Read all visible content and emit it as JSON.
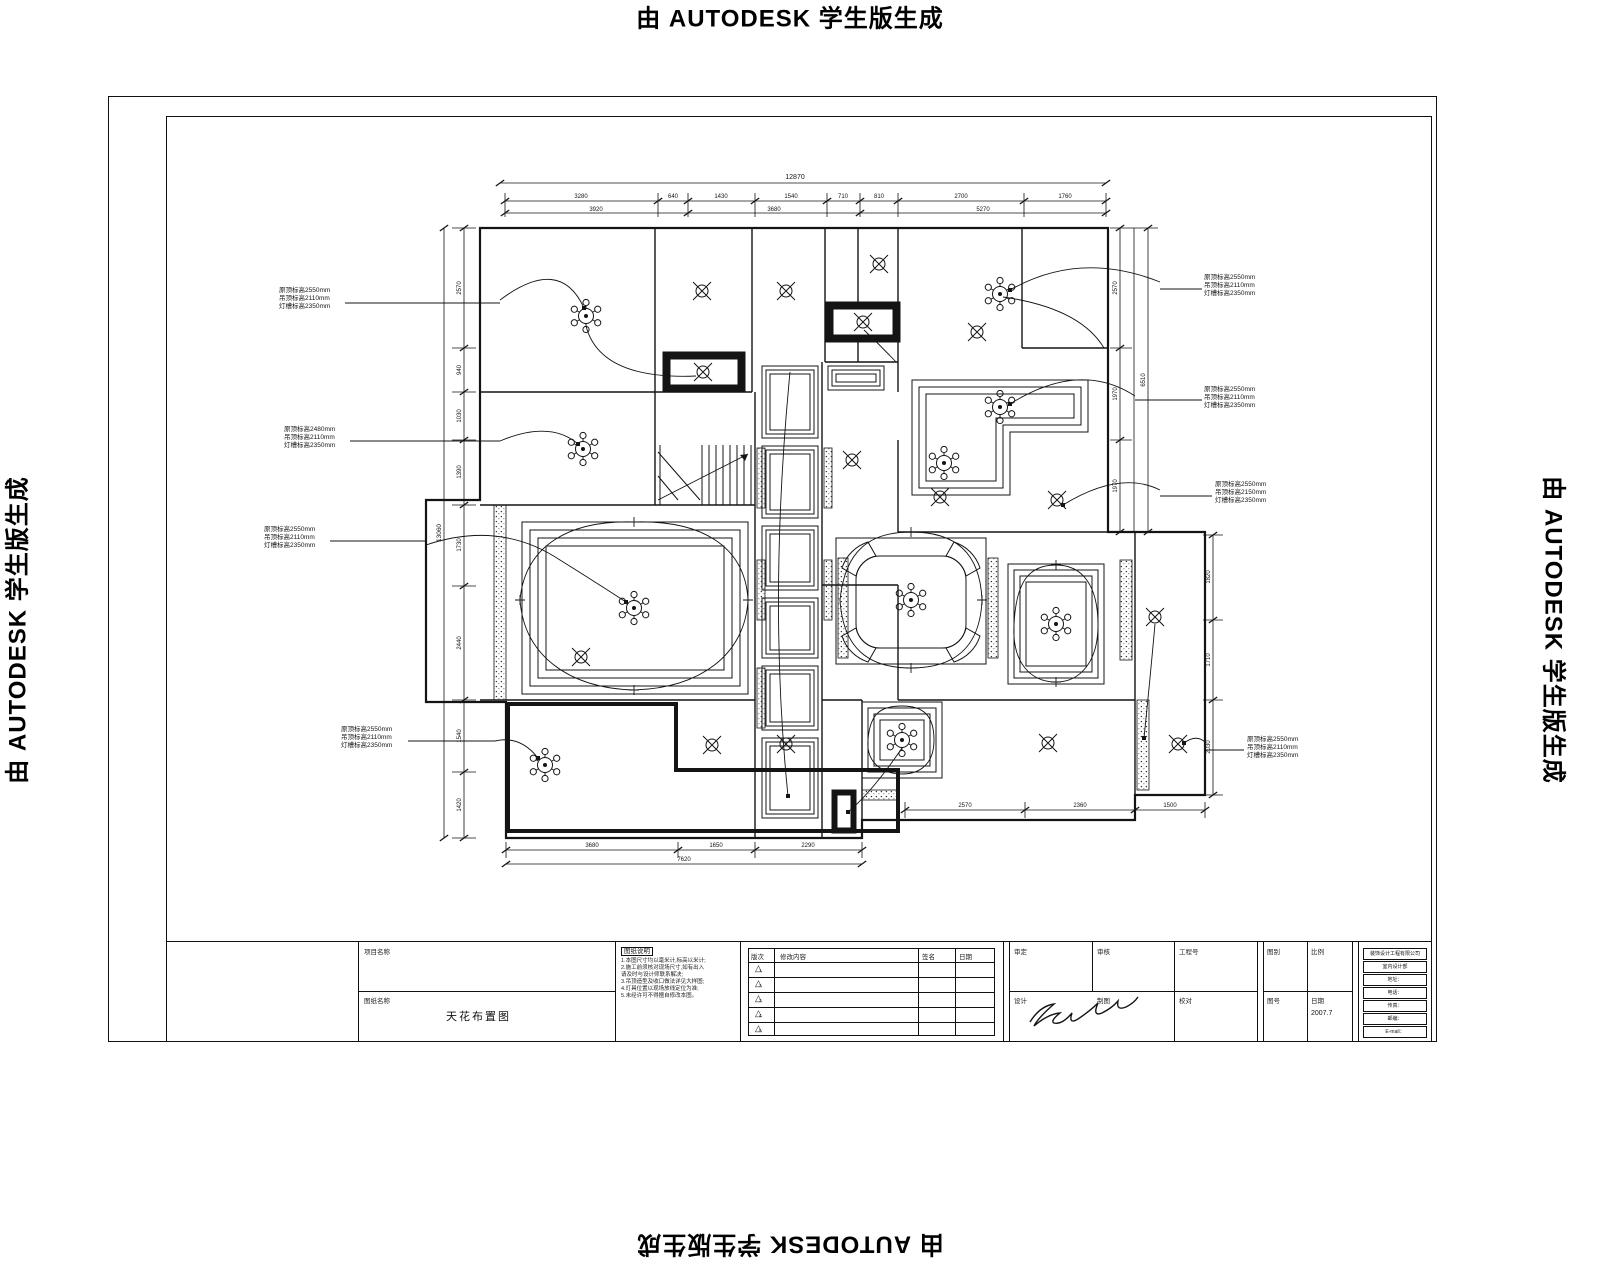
{
  "watermark": {
    "text": "由 AUTODESK 学生版生成"
  },
  "drawing": {
    "annotations": {
      "left": [
        {
          "lines": [
            "原顶标高2550mm",
            "吊顶标高2110mm",
            "灯槽标高2350mm"
          ]
        },
        {
          "lines": [
            "原顶标高2480mm",
            "吊顶标高2110mm",
            "灯槽标高2350mm"
          ]
        },
        {
          "lines": [
            "原顶标高2550mm",
            "吊顶标高2110mm",
            "灯槽标高2350mm"
          ]
        },
        {
          "lines": [
            "原顶标高2550mm",
            "吊顶标高2110mm",
            "灯槽标高2350mm"
          ]
        }
      ],
      "right": [
        {
          "lines": [
            "原顶标高2550mm",
            "吊顶标高2110mm",
            "灯槽标高2350mm"
          ]
        },
        {
          "lines": [
            "原顶标高2550mm",
            "吊顶标高2110mm",
            "灯槽标高2350mm"
          ]
        },
        {
          "lines": [
            "原顶标高2550mm",
            "吊顶标高2150mm",
            "灯槽标高2350mm"
          ]
        },
        {
          "lines": [
            "原顶标高2550mm",
            "吊顶标高2110mm",
            "灯槽标高2350mm"
          ]
        }
      ]
    },
    "dims": {
      "top_overall": "12870",
      "top": [
        "3280",
        "640",
        "1430",
        "1540",
        "710",
        "810",
        "2700",
        "1760"
      ],
      "top2": [
        "3920",
        "3680",
        "5270"
      ],
      "left": [
        "2570",
        "940",
        "1030",
        "1390",
        "1730",
        "2440",
        "1540",
        "1420"
      ],
      "left_overall": "13060",
      "right": [
        "2570",
        "1970",
        "1970",
        "6510",
        "1820",
        "1710",
        "2030"
      ],
      "bottom": [
        "3680",
        "1650",
        "2290",
        "7620",
        "2570",
        "2360",
        "1500"
      ]
    },
    "symbols": {
      "chandelier": "chandelier-light",
      "downlight": "ceiling-downlight"
    }
  },
  "titleblock": {
    "project_label": "项目名称",
    "project_value": "",
    "drawing_label": "图纸名称",
    "drawing_title": "天花布置图",
    "notes_header": "图纸说明",
    "notes_lines": [
      "1.本图尺寸均以毫米计,标高以米计;",
      "2.施工前须核对现场尺寸,如有出入",
      "  请及时与设计师联系解决;",
      "3.吊顶造型及收口做法详见大样图;",
      "4.灯具位置以现场放线定位为准;",
      "5.未经许可不得擅自修改本图。"
    ],
    "revision": {
      "headers": [
        "版次",
        "修改内容",
        "签名",
        "日期"
      ],
      "marks": [
        "1",
        "2",
        "3",
        "4",
        "5"
      ]
    },
    "sign": {
      "row1": [
        "审定",
        "审核",
        "工程号"
      ],
      "row2": [
        "设计",
        "制图",
        "校对"
      ]
    },
    "meta": {
      "row1": [
        {
          "label": "图别",
          "value": ""
        },
        {
          "label": "比例",
          "value": ""
        }
      ],
      "row2": [
        {
          "label": "图号",
          "value": ""
        },
        {
          "label": "日期",
          "value": "2007.7"
        }
      ]
    },
    "company_rows": [
      "装饰设计工程有限公司",
      "室内设计部",
      "地址：",
      "电话：",
      "传真：",
      "邮编：",
      "E-mail："
    ]
  }
}
